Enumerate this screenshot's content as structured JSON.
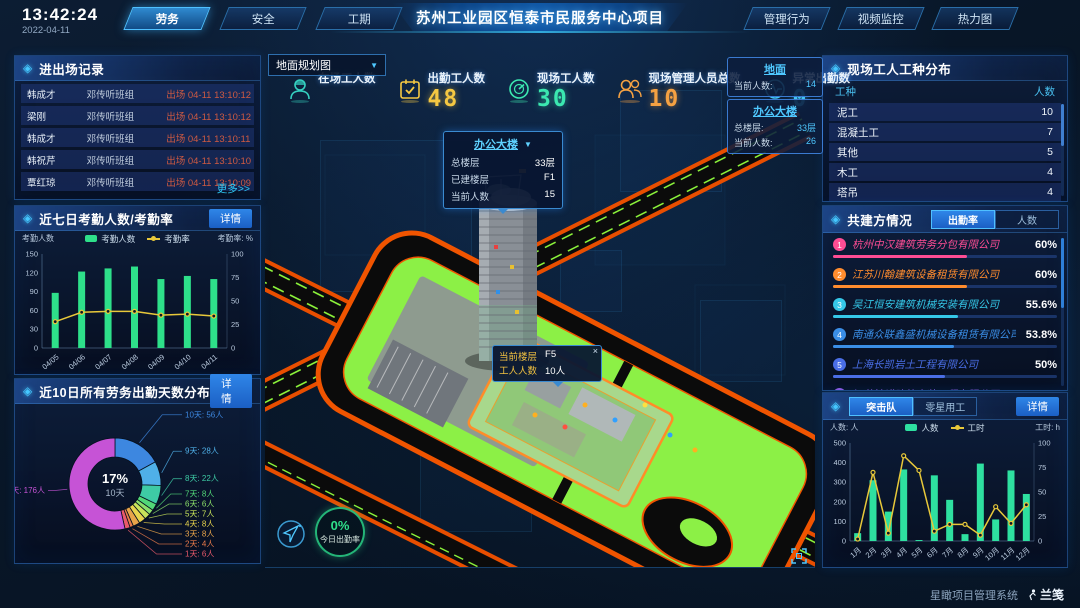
{
  "top_bar": {
    "time": "13:42:24",
    "date": "2022-04-11",
    "left_tabs": [
      {
        "label": "劳务",
        "active": true
      },
      {
        "label": "安全",
        "active": false
      },
      {
        "label": "工期",
        "active": false
      }
    ],
    "title": "苏州工业园区恒泰市民服务中心项目",
    "right_tabs": [
      {
        "label": "管理行为",
        "active": false
      },
      {
        "label": "视频监控",
        "active": false
      },
      {
        "label": "热力图",
        "active": false
      }
    ]
  },
  "entry_exit_panel": {
    "title": "进出场记录",
    "more_link": "更多>>",
    "rows": [
      {
        "name": "韩成才",
        "group": "邓传听班组",
        "event": "出场 04-11 13:10:12"
      },
      {
        "name": "梁刚",
        "group": "邓传听班组",
        "event": "出场 04-11 13:10:12"
      },
      {
        "name": "韩成才",
        "group": "邓传听班组",
        "event": "出场 04-11 13:10:11"
      },
      {
        "name": "韩祝芹",
        "group": "邓传听班组",
        "event": "出场 04-11 13:10:10"
      },
      {
        "name": "覃红琼",
        "group": "邓传听班组",
        "event": "出场 04-11 13:10:09"
      }
    ]
  },
  "attendance_panel": {
    "title": "近七日考勤人数/考勤率",
    "detail_button": "详情"
  },
  "distribution_panel": {
    "title": "近10日所有劳务出勤天数分布",
    "detail_button": "详情"
  },
  "map_area": {
    "view_select": {
      "value": "地面规划图"
    },
    "stats": [
      {
        "label": "在场工人数",
        "value": "",
        "color": "#35d0c0"
      },
      {
        "label": "出勤工人数",
        "value": "48",
        "color": "#f5c842"
      },
      {
        "label": "现场工人数",
        "value": "30",
        "color": "#3be8b0"
      },
      {
        "label": "现场管理人员总数",
        "value": "10",
        "color": "#f5a142"
      },
      {
        "label": "异常出勤数",
        "value": "0",
        "color": "#42c6f5"
      }
    ],
    "building_popup": {
      "title": "办公大楼",
      "rows": [
        {
          "label": "总楼层",
          "value": "33层"
        },
        {
          "label": "已建楼层",
          "value": "F1"
        },
        {
          "label": "当前人数",
          "value": "15"
        }
      ]
    },
    "info_cards": [
      {
        "title": "地面",
        "rows": [
          {
            "label": "当前人数:",
            "value": "14"
          }
        ]
      },
      {
        "title": "办公大楼",
        "rows": [
          {
            "label": "总楼层:",
            "value": "33层"
          },
          {
            "label": "当前人数:",
            "value": "26"
          }
        ]
      }
    ],
    "floor_tooltip": {
      "close": "×",
      "rows": [
        {
          "label": "当前楼层",
          "value": "F5"
        },
        {
          "label": "工人人数",
          "value": "10人"
        }
      ]
    },
    "attendance_badge": {
      "value": "0%",
      "label": "今日出勤率"
    }
  },
  "worker_type_panel": {
    "title": "现场工人工种分布",
    "columns": [
      "工种",
      "人数"
    ],
    "rows": [
      {
        "type": "泥工",
        "count": "10"
      },
      {
        "type": "混凝土工",
        "count": "7"
      },
      {
        "type": "其他",
        "count": "5"
      },
      {
        "type": "木工",
        "count": "4"
      },
      {
        "type": "塔吊",
        "count": "4"
      }
    ]
  },
  "partner_panel": {
    "title": "共建方情况",
    "tabs": [
      {
        "label": "出勤率",
        "active": true
      },
      {
        "label": "人数",
        "active": false
      }
    ],
    "items": [
      {
        "rank": "1",
        "name": "杭州中汉建筑劳务分包有限公司",
        "value": "60%",
        "pct": 60,
        "color": "#ff4d94"
      },
      {
        "rank": "2",
        "name": "江苏川翰建筑设备租赁有限公司",
        "value": "60%",
        "pct": 60,
        "color": "#ff8c2e"
      },
      {
        "rank": "3",
        "name": "吴江恒安建筑机械安装有限公司",
        "value": "55.6%",
        "pct": 55.6,
        "color": "#35c8e8"
      },
      {
        "rank": "4",
        "name": "南通众联鑫盛机械设备租赁有限公司",
        "value": "53.8%",
        "pct": 53.8,
        "color": "#3a8ee6"
      },
      {
        "rank": "5",
        "name": "上海长凯岩土工程有限公司",
        "value": "50%",
        "pct": 50,
        "color": "#4a6ee6"
      },
      {
        "rank": "6",
        "name": "江苏法诺建筑安装工程有限公司",
        "value": "35.4%",
        "pct": 35.4,
        "color": "#8a5ae0"
      }
    ]
  },
  "assault_panel": {
    "tabs": [
      {
        "label": "突击队",
        "active": true
      },
      {
        "label": "零星用工",
        "active": false
      }
    ],
    "detail_button": "详情"
  },
  "footer": {
    "system_name": "星瞰项目管理系统",
    "logo": "兰笺"
  },
  "chart_data": {
    "attendance7": {
      "type": "bar+line",
      "categories": [
        "04/05",
        "04/06",
        "04/07",
        "04/08",
        "04/09",
        "04/10",
        "04/11"
      ],
      "series": [
        {
          "name": "考勤人数",
          "type": "bar",
          "axis": "left",
          "color": "#2ee08a",
          "values": [
            88,
            122,
            127,
            130,
            110,
            115,
            110
          ]
        },
        {
          "name": "考勤率",
          "type": "line",
          "axis": "right",
          "color": "#e8c83a",
          "values": [
            28,
            38,
            39,
            39,
            35,
            36,
            34
          ]
        }
      ],
      "left_axis": {
        "label": "考勤人数",
        "max": 150,
        "ticks": [
          0,
          30,
          60,
          90,
          120,
          150
        ]
      },
      "right_axis": {
        "label": "考勤率: %",
        "max": 100,
        "ticks": [
          0,
          25,
          50,
          75,
          100
        ]
      },
      "legend_position": "top"
    },
    "distribution10": {
      "type": "donut",
      "center": {
        "percent": "17%",
        "label": "10天"
      },
      "slices": [
        {
          "label": "10天",
          "count": "56人",
          "value": 56,
          "color": "#3d87e0"
        },
        {
          "label": "9天",
          "count": "28人",
          "value": 28,
          "color": "#4fb0e8"
        },
        {
          "label": "8天",
          "count": "22人",
          "value": 22,
          "color": "#3ecba5"
        },
        {
          "label": "7天",
          "count": "8人",
          "value": 8,
          "color": "#52d878"
        },
        {
          "label": "6天",
          "count": "6人",
          "value": 6,
          "color": "#8ce06a"
        },
        {
          "label": "5天",
          "count": "7人",
          "value": 7,
          "color": "#c8e45a"
        },
        {
          "label": "4天",
          "count": "8人",
          "value": 8,
          "color": "#e8d44d"
        },
        {
          "label": "3天",
          "count": "8人",
          "value": 8,
          "color": "#e8a44a"
        },
        {
          "label": "2天",
          "count": "4人",
          "value": 4,
          "color": "#e87a4a"
        },
        {
          "label": "1天",
          "count": "6人",
          "value": 6,
          "color": "#e85a6a"
        },
        {
          "label": "0天",
          "count": "176人",
          "value": 176,
          "color": "#c653d6"
        }
      ]
    },
    "assault_monthly": {
      "type": "bar+line",
      "categories": [
        "1月",
        "2月",
        "3月",
        "4月",
        "5月",
        "6月",
        "7月",
        "8月",
        "9月",
        "10月",
        "11月",
        "12月"
      ],
      "series": [
        {
          "name": "人数",
          "type": "bar",
          "axis": "left",
          "color": "#2ee0a0",
          "values": [
            40,
            310,
            150,
            365,
            5,
            335,
            210,
            35,
            395,
            110,
            360,
            240
          ]
        },
        {
          "name": "工时",
          "type": "line",
          "axis": "right",
          "color": "#e8c83a",
          "values": [
            2,
            70,
            8,
            87,
            72,
            10,
            17,
            17,
            6,
            35,
            18,
            37
          ]
        }
      ],
      "left_axis": {
        "label": "人数: 人",
        "max": 500,
        "ticks": [
          0,
          100,
          200,
          300,
          400,
          500
        ]
      },
      "right_axis": {
        "label": "工时: h",
        "max": 100,
        "ticks": [
          0,
          25,
          50,
          75,
          100
        ]
      },
      "legend_position": "top"
    }
  }
}
